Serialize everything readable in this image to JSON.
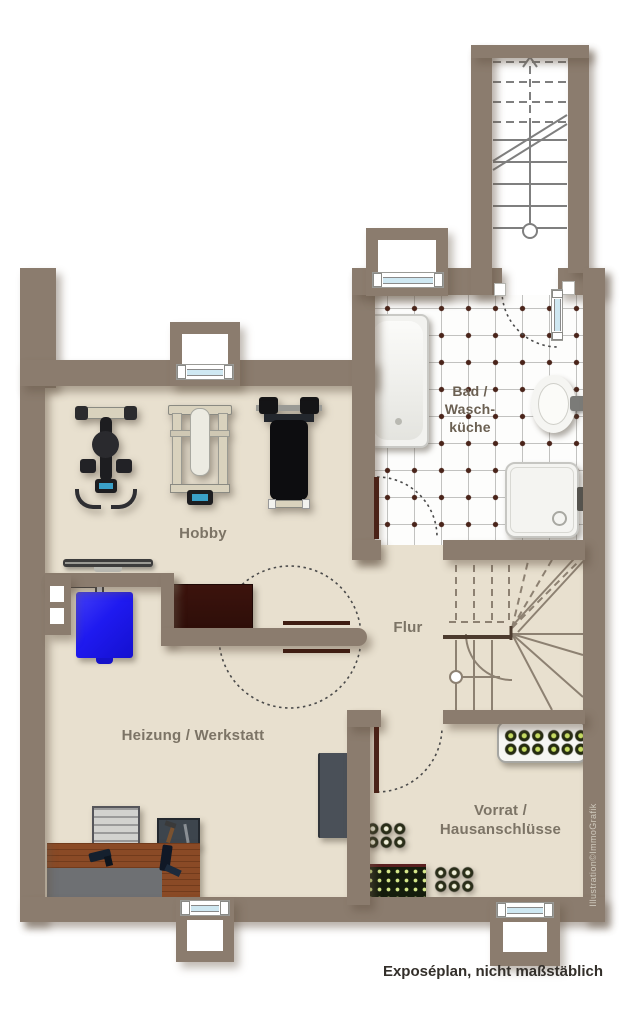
{
  "rooms": {
    "hobby": {
      "label": "Hobby"
    },
    "flur": {
      "label": "Flur"
    },
    "bad": {
      "line1": "Bad /",
      "line2": "Wasch-",
      "line3": "küche"
    },
    "heizung": {
      "label": "Heizung / Werkstatt"
    },
    "vorrat": {
      "line1": "Vorrat /",
      "line2": "Hausanschlüsse"
    }
  },
  "caption": "Exposéplan, nicht maßstäblich",
  "watermark": "Illustration©ImmoGrafik",
  "furniture": [
    "bathtub",
    "sink",
    "shower-tray",
    "exercise-bike",
    "multi-gym",
    "weight-bench",
    "radiator",
    "oil-tank",
    "chimney",
    "table",
    "utility-cabinet",
    "shelf-unit",
    "tool-cabinet",
    "workbench",
    "bottle-tray",
    "bottle-crate",
    "stairs-upper",
    "stairs-lower"
  ],
  "colors": {
    "wall": "#8b7c6e",
    "floor": "#e8e0cf",
    "tile_dot": "#4a241a",
    "window_glass": "#cfe8f2",
    "tank_blue": "#1f1af0",
    "door_leaf": "#4a2217",
    "label_text": "#7c7466",
    "caption_text": "#332f2a"
  }
}
